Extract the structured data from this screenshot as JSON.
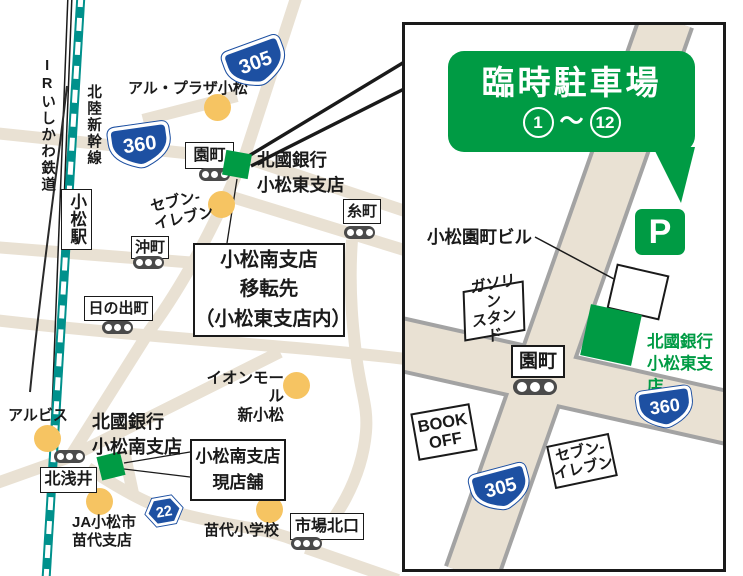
{
  "colors": {
    "brand_green": "#009b44",
    "badge_blue": "#1d50a2",
    "road_beige": "#e9e1d3",
    "road_casing_gray": "#a3a3a3",
    "rail_teal": "#00918c",
    "poi_yellow": "#f6c462",
    "signal_gray": "#4a4a4a",
    "text_black": "#1a1a1a"
  },
  "left_map": {
    "rail": {
      "ir_line": "IRいしかわ鉄道",
      "shinkansen": "北陸新幹線",
      "station": "小松駅"
    },
    "badges": [
      {
        "num": "360"
      },
      {
        "num": "305"
      },
      {
        "num": "22"
      }
    ],
    "signals": [
      {
        "label": "園町"
      },
      {
        "label": "糸町"
      },
      {
        "label": "沖町"
      },
      {
        "label": "日の出町"
      },
      {
        "label": "北浅井"
      },
      {
        "label": "市場北口"
      }
    ],
    "pois": [
      {
        "label": "アル・プラザ小松"
      },
      {
        "label": "セブン-\nイレブン"
      },
      {
        "label": "イオンモール\n新小松"
      },
      {
        "label": "アルビス"
      },
      {
        "label": "JA小松市\n苗代支店"
      },
      {
        "label": "苗代小学校"
      }
    ],
    "banks": [
      {
        "label": "北國銀行\n小松東支店"
      },
      {
        "label": "北國銀行\n小松南支店"
      }
    ],
    "callouts": [
      {
        "text": "小松南支店\n移転先\n（小松東支店内）"
      },
      {
        "text": "小松南支店\n現店舗"
      }
    ]
  },
  "inset": {
    "banner": {
      "title": "臨時駐車場",
      "from": "1",
      "tilde": "〜",
      "to": "12"
    },
    "parking": "P",
    "building": "小松園町ビル",
    "bank": "北國銀行\n小松東支店",
    "gas": "ガソリン\nスタンド",
    "bookoff": "BOOK\nOFF",
    "seven": "セブン-\nイレブン",
    "signal": "園町",
    "badges": [
      {
        "num": "360"
      },
      {
        "num": "305"
      }
    ]
  }
}
